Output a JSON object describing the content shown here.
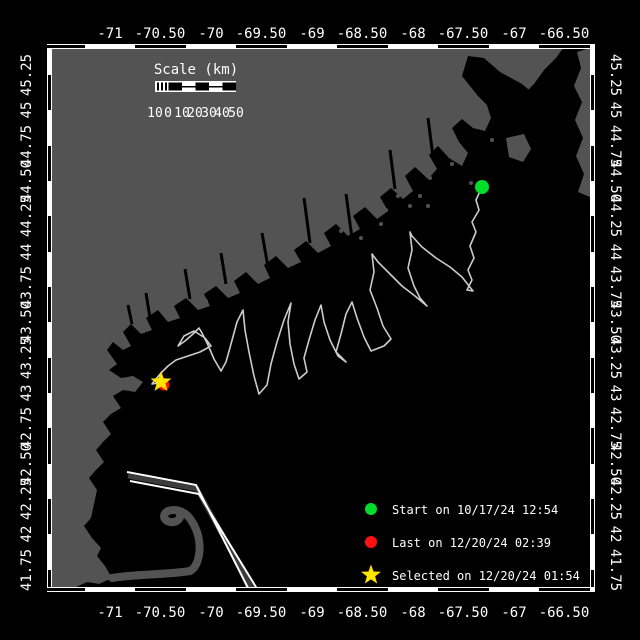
{
  "window": {
    "background": "#000000"
  },
  "axes": {
    "lon": [
      "-71",
      "-70.50",
      "-70",
      "-69.50",
      "-69",
      "-68.50",
      "-68",
      "-67.50",
      "-67",
      "-66.50"
    ],
    "lat": [
      "45.25",
      "45",
      "44.75",
      "44.50",
      "44.25",
      "44",
      "43.75",
      "43.50",
      "43.25",
      "43",
      "42.75",
      "42.50",
      "42.25",
      "42",
      "41.75"
    ]
  },
  "scale_bar": {
    "title": "Scale (km)",
    "ticks": [
      "10",
      "0",
      "10",
      "20",
      "30",
      "40",
      "50"
    ]
  },
  "legend": {
    "start_label": "Start on 10/17/24 12:54",
    "last_label": "Last on 12/20/24 02:39",
    "selected_label": "Selected on 12/20/24 01:54"
  },
  "markers": {
    "start_color": "#00dd2a",
    "last_color": "#ff1111",
    "selected_color": "#ffe400"
  },
  "colors": {
    "land": "#535353",
    "water": "#000000",
    "track": "#cccccc",
    "frame": "#ffffff",
    "lane_median": "#3c3c3c"
  }
}
